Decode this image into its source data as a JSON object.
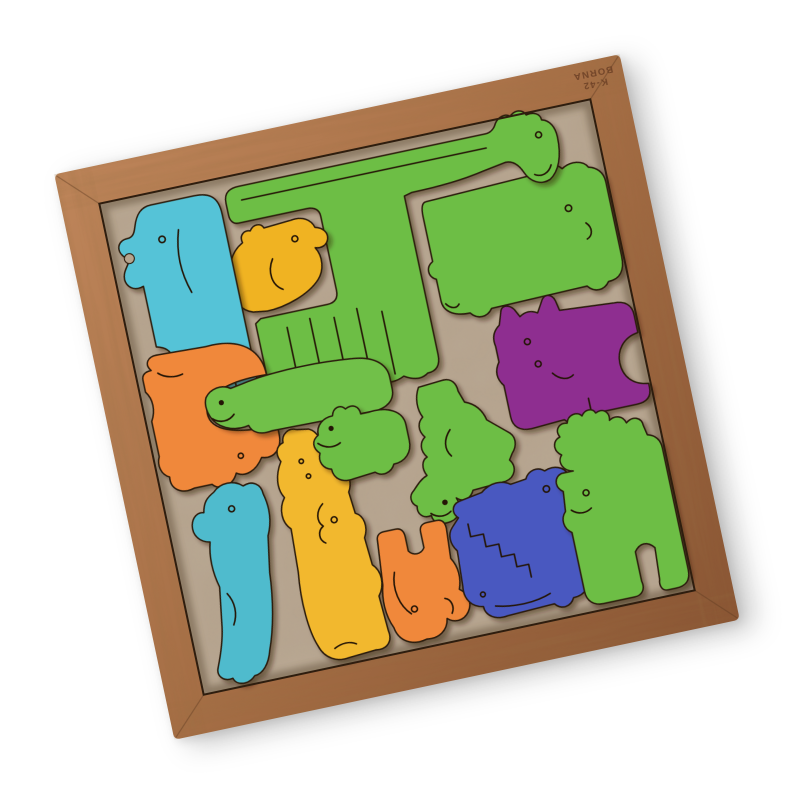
{
  "scene": {
    "background_color": "#ffffff",
    "stamp": {
      "line1": "K-42",
      "line2": "BORNA"
    },
    "frame": {
      "wood_light": "#BE855A",
      "wood_mid": "#A56E45",
      "wood_dark": "#8A5634",
      "seam_color": "#5f3c22"
    },
    "board": {
      "base": "#B6A48E",
      "speck": "#6b5a45"
    },
    "outline_color": "#2b1a0a",
    "rotation_deg": -12,
    "pieces": [
      {
        "name": "teal-elephant",
        "animal": "elephant",
        "color": "#55C3D7"
      },
      {
        "name": "yellow-duck",
        "animal": "duck",
        "color": "#F0B322"
      },
      {
        "name": "green-giraffe",
        "animal": "giraffe",
        "color": "#6DBE45"
      },
      {
        "name": "green-hippo",
        "animal": "hippo",
        "color": "#6DBE45"
      },
      {
        "name": "purple-cat",
        "animal": "cat",
        "color": "#8E2F90"
      },
      {
        "name": "orange-hippo",
        "animal": "hippo",
        "color": "#F0883A"
      },
      {
        "name": "green-goose",
        "animal": "goose",
        "color": "#71C04A"
      },
      {
        "name": "green-duckling",
        "animal": "duckling",
        "color": "#6DBE45"
      },
      {
        "name": "green-kangaroo",
        "animal": "kangaroo",
        "color": "#6DBE45"
      },
      {
        "name": "teal-seal",
        "animal": "seal",
        "color": "#4FBBCD"
      },
      {
        "name": "yellow-kangaroo",
        "animal": "kangaroo",
        "color": "#F2B82F"
      },
      {
        "name": "orange-elephant",
        "animal": "elephant",
        "color": "#F0883A"
      },
      {
        "name": "blue-hippo",
        "animal": "hippo",
        "color": "#4A58C0"
      },
      {
        "name": "green-moose",
        "animal": "moose",
        "color": "#6DBE45"
      }
    ]
  }
}
